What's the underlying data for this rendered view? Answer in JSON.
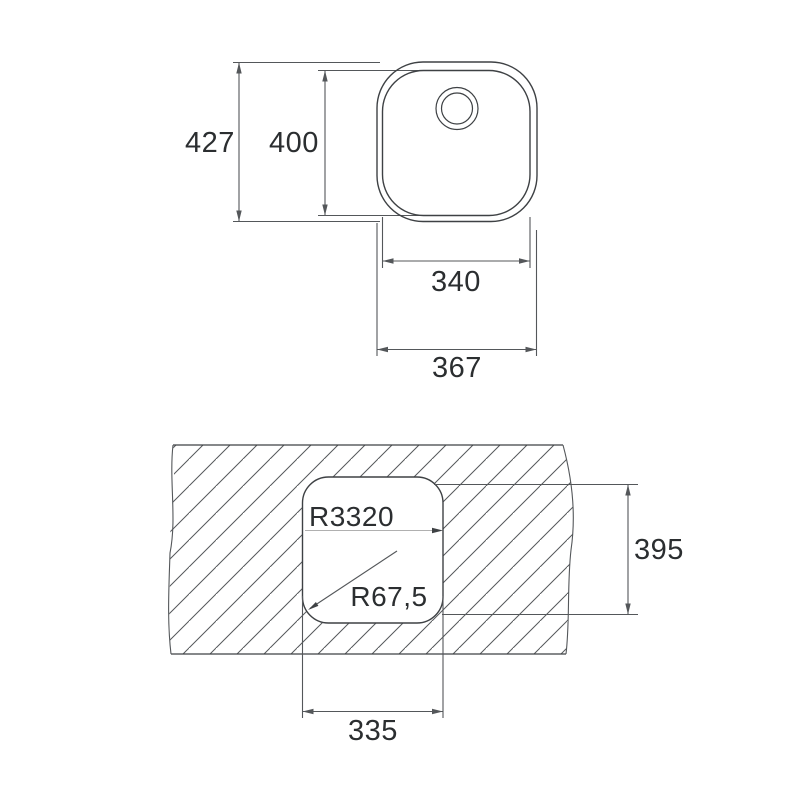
{
  "drawing": {
    "type": "technical-dimension-drawing",
    "subject": "undermount-sink",
    "colors": {
      "background": "#ffffff",
      "outline": "#3e4144",
      "dimension_lines": "#54575a",
      "hatch_lines": "#55585b",
      "text": "#2b2e30",
      "leader_light": "#b0b0b0"
    },
    "icons": {
      "drain": "concentric-circles"
    },
    "top_view": {
      "dim_total_height": "427",
      "dim_bowl_height": "400",
      "dim_bowl_width": "340",
      "dim_total_width": "367"
    },
    "cutout_view": {
      "radius_label_large": "R3320",
      "radius_label_corner": "R67,5",
      "dim_cutout_height": "395",
      "dim_cutout_width": "335"
    }
  }
}
